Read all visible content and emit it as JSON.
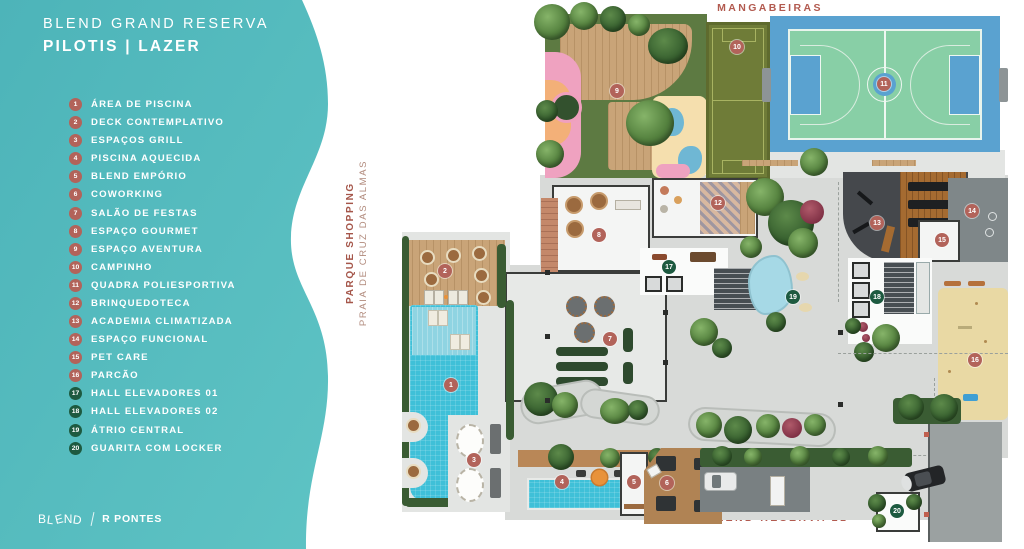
{
  "sidebar": {
    "title": "BLEND GRAND RESERVA",
    "subtitle": "PILOTIS | LAZER",
    "legend": [
      {
        "num": "1",
        "label": "ÁREA DE PISCINA",
        "group": "amenity"
      },
      {
        "num": "2",
        "label": "DECK CONTEMPLATIVO",
        "group": "amenity"
      },
      {
        "num": "3",
        "label": "ESPAÇOS GRILL",
        "group": "amenity"
      },
      {
        "num": "4",
        "label": "PISCINA AQUECIDA",
        "group": "amenity"
      },
      {
        "num": "5",
        "label": "BLEND EMPÓRIO",
        "group": "amenity"
      },
      {
        "num": "6",
        "label": "COWORKING",
        "group": "amenity"
      },
      {
        "num": "7",
        "label": "SALÃO DE FESTAS",
        "group": "amenity"
      },
      {
        "num": "8",
        "label": "ESPAÇO GOURMET",
        "group": "amenity"
      },
      {
        "num": "9",
        "label": "ESPAÇO AVENTURA",
        "group": "amenity"
      },
      {
        "num": "10",
        "label": "CAMPINHO",
        "group": "amenity"
      },
      {
        "num": "11",
        "label": "QUADRA POLIESPORTIVA",
        "group": "amenity"
      },
      {
        "num": "12",
        "label": "BRINQUEDOTECA",
        "group": "amenity"
      },
      {
        "num": "13",
        "label": "ACADEMIA CLIMATIZADA",
        "group": "amenity"
      },
      {
        "num": "14",
        "label": "ESPAÇO FUNCIONAL",
        "group": "amenity"
      },
      {
        "num": "15",
        "label": "PET CARE",
        "group": "amenity"
      },
      {
        "num": "16",
        "label": "PARCÃO",
        "group": "amenity"
      },
      {
        "num": "17",
        "label": "HALL ELEVADORES 01",
        "group": "circulation"
      },
      {
        "num": "18",
        "label": "HALL ELEVADORES 02",
        "group": "circulation"
      },
      {
        "num": "19",
        "label": "ÁTRIO CENTRAL",
        "group": "circulation"
      },
      {
        "num": "20",
        "label": "GUARITA COM LOCKER",
        "group": "circulation"
      }
    ],
    "footer": {
      "brand": "BLEND",
      "partner": "R PONTES"
    }
  },
  "plan": {
    "labels": {
      "top_street": "MANGABEIRAS",
      "left_street_primary": "PARQUE SHOPPING",
      "left_street_secondary": "PRAIA DE CRUZ DAS ALMAS",
      "bottom_street": "BLEND RESERVA 21"
    },
    "markers": [
      {
        "num": "1",
        "x": 451,
        "y": 385,
        "group": "amenity"
      },
      {
        "num": "2",
        "x": 445,
        "y": 271,
        "group": "amenity"
      },
      {
        "num": "3",
        "x": 474,
        "y": 460,
        "group": "amenity"
      },
      {
        "num": "4",
        "x": 562,
        "y": 482,
        "group": "amenity"
      },
      {
        "num": "5",
        "x": 634,
        "y": 482,
        "group": "amenity"
      },
      {
        "num": "6",
        "x": 667,
        "y": 483,
        "group": "amenity"
      },
      {
        "num": "7",
        "x": 610,
        "y": 339,
        "group": "amenity"
      },
      {
        "num": "8",
        "x": 599,
        "y": 235,
        "group": "amenity"
      },
      {
        "num": "9",
        "x": 617,
        "y": 91,
        "group": "amenity"
      },
      {
        "num": "10",
        "x": 737,
        "y": 47,
        "group": "amenity"
      },
      {
        "num": "11",
        "x": 884,
        "y": 84,
        "group": "amenity"
      },
      {
        "num": "12",
        "x": 718,
        "y": 203,
        "group": "amenity"
      },
      {
        "num": "13",
        "x": 877,
        "y": 223,
        "group": "amenity"
      },
      {
        "num": "14",
        "x": 972,
        "y": 211,
        "group": "amenity"
      },
      {
        "num": "15",
        "x": 942,
        "y": 240,
        "group": "amenity"
      },
      {
        "num": "16",
        "x": 975,
        "y": 360,
        "group": "amenity"
      },
      {
        "num": "17",
        "x": 669,
        "y": 267,
        "group": "circulation"
      },
      {
        "num": "18",
        "x": 877,
        "y": 297,
        "group": "circulation"
      },
      {
        "num": "19",
        "x": 793,
        "y": 297,
        "group": "circulation"
      },
      {
        "num": "20",
        "x": 897,
        "y": 511,
        "group": "circulation"
      }
    ]
  },
  "colors": {
    "sidebar_teal_top": "#4db4b9",
    "sidebar_teal_bottom": "#5ec3c4",
    "marker_amenity": "#b2635a",
    "marker_circulation": "#1d5a40",
    "street_label": "#b25a4f",
    "pool_blue": "#3fc0d8",
    "court_blue": "#5aa2d0",
    "court_green": "#88cfa6",
    "campinho_olive": "#6f7c38",
    "playground_grass": "#5d7a42",
    "parcao_sand": "#e9d9a4"
  }
}
